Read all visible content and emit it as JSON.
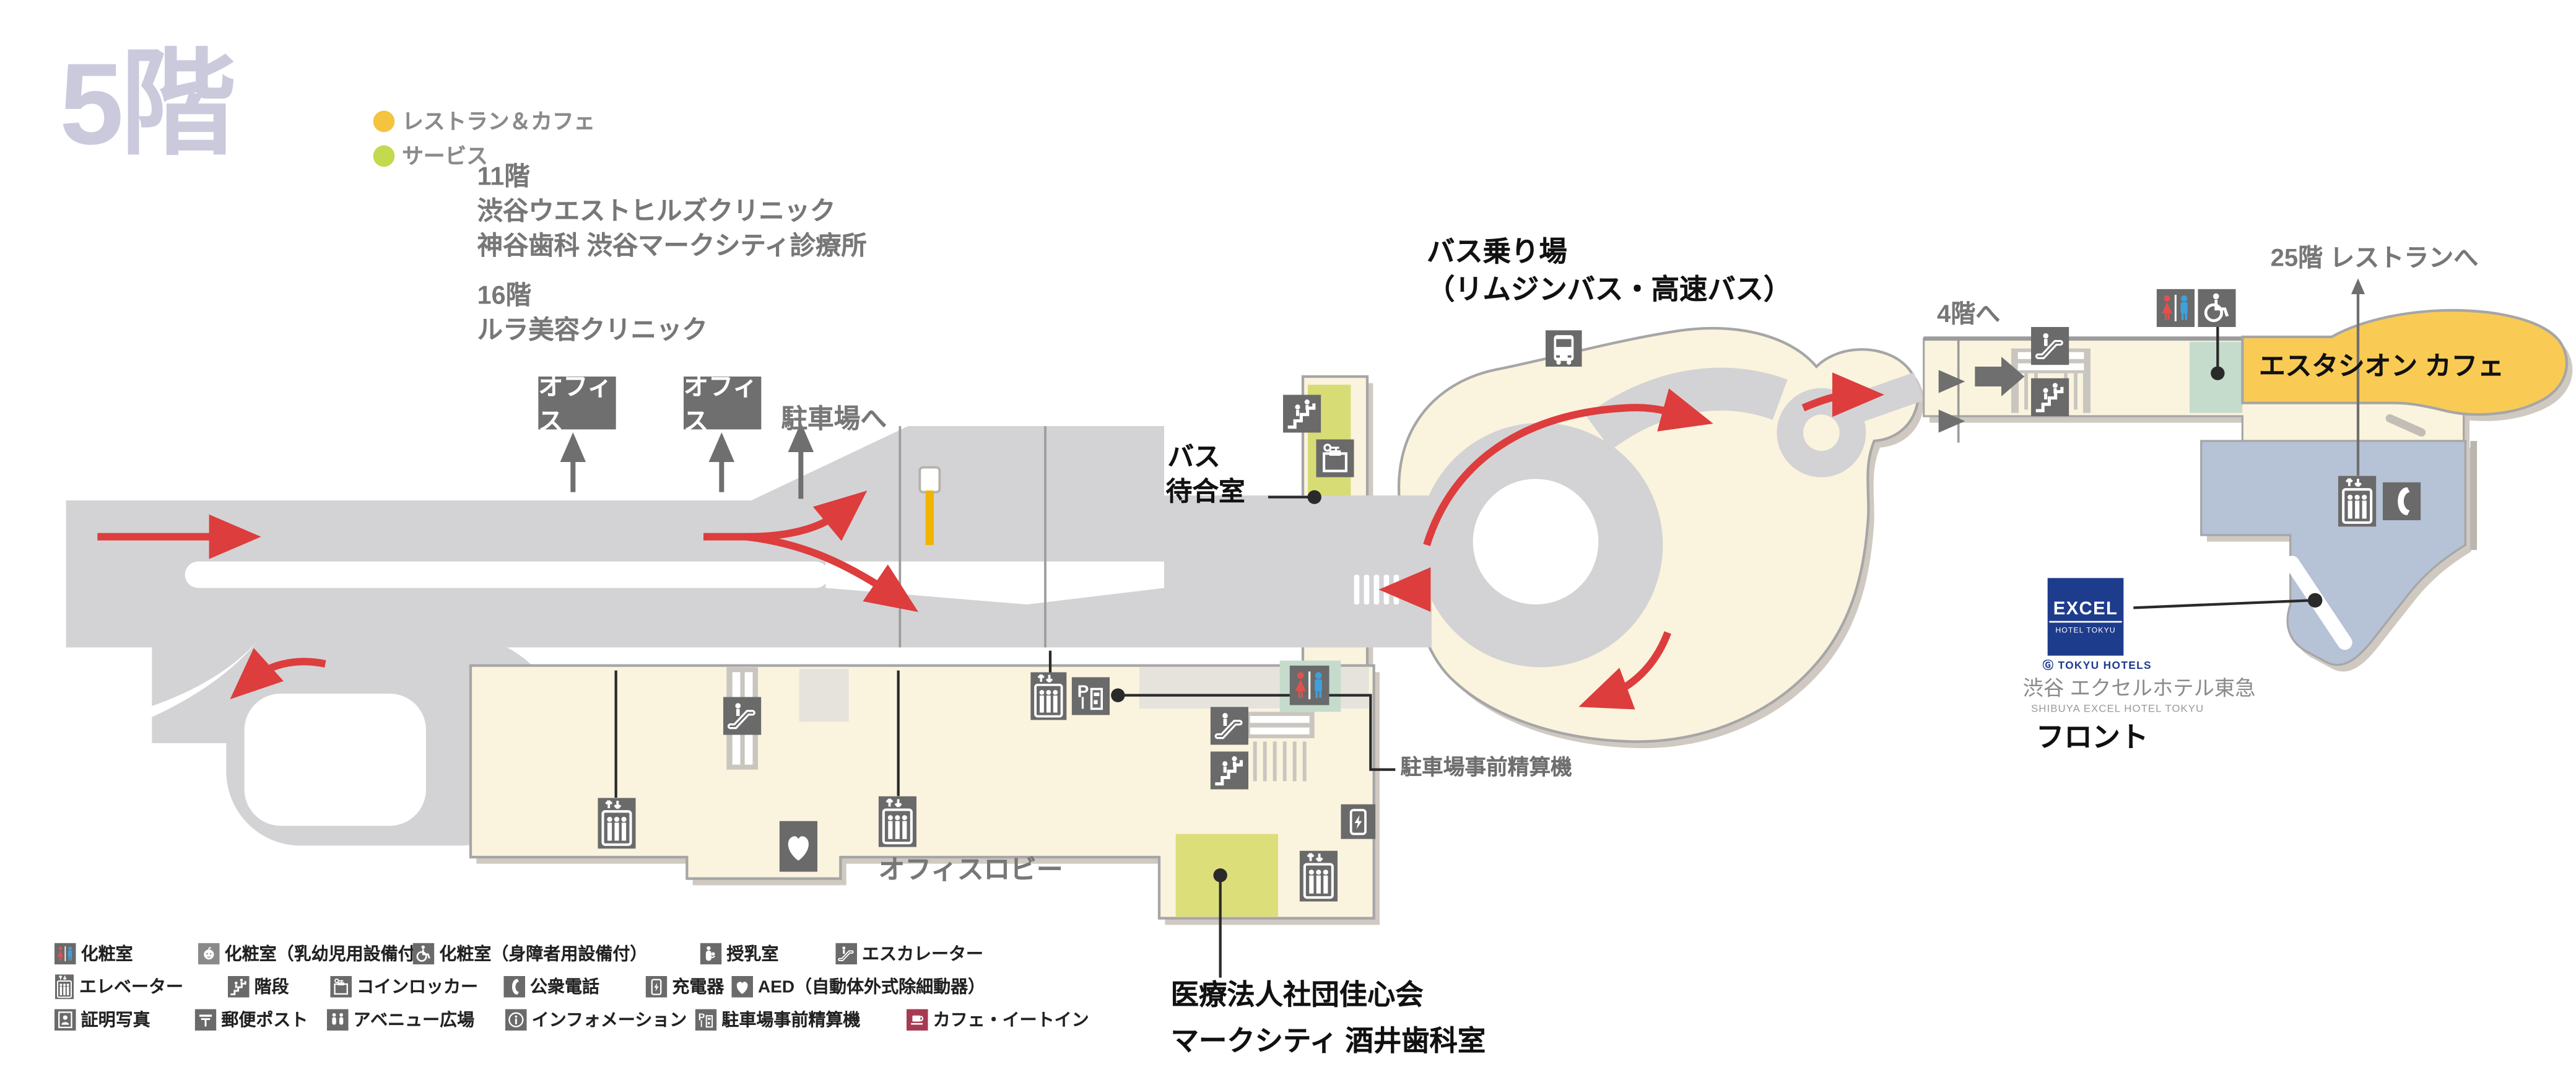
{
  "floor": {
    "title": "5階"
  },
  "area_legend": {
    "restaurant_cafe": {
      "label": "レストラン＆カフェ",
      "color": "#F4C440"
    },
    "service": {
      "label": "サービス",
      "color": "#C3D94E"
    }
  },
  "notes": {
    "f11_title": "11階",
    "f11_line1": "渋谷ウエストヒルズクリニック",
    "f11_line2": "神谷歯科 渋谷マークシティ診療所",
    "f16_title": "16階",
    "f16_line1": "ルラ美容クリニック"
  },
  "map": {
    "office_label_1": "オフィス",
    "office_label_2": "オフィス",
    "to_parking": "駐車場へ",
    "bus_stop_line1": "バス乗り場",
    "bus_stop_line2": "（リムジンバス・高速バス）",
    "bus_waiting_line1": "バス",
    "bus_waiting_line2": "待合室",
    "to_4f": "4階へ",
    "to_25f": "25階 レストランへ",
    "estacion_cafe": "エスタシオン カフェ",
    "parking_payment": "駐車場事前精算機",
    "office_lobby": "オフィスロビー",
    "dental_line1": "医療法人社団佳心会",
    "dental_line2": "マークシティ 酒井歯科室",
    "hotel": {
      "logo_line1": "EXCEL",
      "logo_line2": "HOTEL TOKYU",
      "logo_sub": "Ⓖ TOKYU HOTELS",
      "name_jp": "渋谷 エクセルホテル東急",
      "name_en": "SHIBUYA EXCEL HOTEL TOKYU",
      "front": "フロント"
    }
  },
  "legend": {
    "rows": [
      {
        "items": [
          {
            "icon": "restroom-icon",
            "label": "化粧室"
          },
          {
            "icon": "baby-icon",
            "label": "化粧室（乳幼児用設備付）"
          },
          {
            "icon": "wheelchair-icon",
            "label": "化粧室（身障者用設備付）"
          },
          {
            "icon": "nursing-icon",
            "label": "授乳室"
          },
          {
            "icon": "escalator-icon",
            "label": "エスカレーター"
          }
        ]
      },
      {
        "items": [
          {
            "icon": "elevator-icon",
            "label": "エレベーター"
          },
          {
            "icon": "stairs-icon",
            "label": "階段"
          },
          {
            "icon": "locker-icon",
            "label": "コインロッカー"
          },
          {
            "icon": "phone-icon",
            "label": "公衆電話"
          },
          {
            "icon": "charger-icon",
            "label": "充電器"
          },
          {
            "icon": "aed-icon",
            "label": "AED（自動体外式除細動器）"
          }
        ]
      },
      {
        "items": [
          {
            "icon": "photo-icon",
            "label": "証明写真"
          },
          {
            "icon": "post-icon",
            "label": "郵便ポスト"
          },
          {
            "icon": "plaza-icon",
            "label": "アベニュー広場"
          },
          {
            "icon": "info-icon",
            "label": "インフォメーション"
          },
          {
            "icon": "parking-payment-icon",
            "label": "駐車場事前精算機"
          },
          {
            "icon": "cafe-icon",
            "label": "カフェ・イートイン"
          }
        ]
      }
    ]
  },
  "colors": {
    "road": "#D3D3D5",
    "floor": "#FAF3DE",
    "service_green": "#D8DC74",
    "cafe_yellow": "#F9CB55",
    "hotel_blue": "#B6C2D5",
    "teal_room": "#C5DCCD",
    "icon_gray": "#6A6A6A",
    "arrow_red": "#DD3D3D",
    "logo_navy": "#1E3C8C",
    "cafe_legend_red": "#A63A52"
  }
}
